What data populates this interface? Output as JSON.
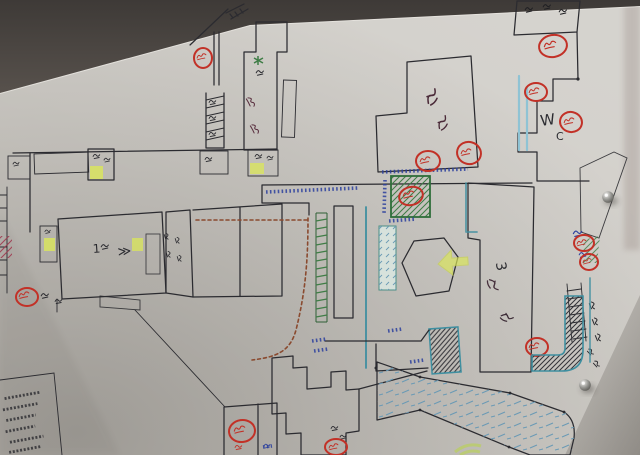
{
  "photo": {
    "alt": "Photograph of a hand-drawn floor map on white paper pinned to a wall; buildings hatched in red, green, purple and dark pencil; red circled marks; dashed brown route; W.C label; two metal pushpins"
  },
  "labels": {
    "wc_w": "W",
    "wc_c": "C",
    "building_right_number": "3",
    "room_left_number": "1",
    "route_arrow": "≫"
  },
  "counts": {
    "red_circle_markers": 13,
    "pushpins": 2,
    "legend_lines": 6
  },
  "colors": {
    "paper": "#cbc8c2",
    "wall_top_dark": "#3e3a37",
    "wall_top_light": "#57514c",
    "ink": "#2b2b30",
    "hatch_red": "#a03a50",
    "hatch_purple": "#82335a",
    "hatch_green": "#3f7d46",
    "hatch_dark": "#34343a",
    "marker_red": "#c23127",
    "ink_blue": "#2b3f9e",
    "teal": "#3f8fa0",
    "light_blue": "#8fc3d4",
    "highlight_yellow": "#dbe75a",
    "route_brown": "#8a4a2f",
    "band_blue": "#6b9ab5"
  }
}
